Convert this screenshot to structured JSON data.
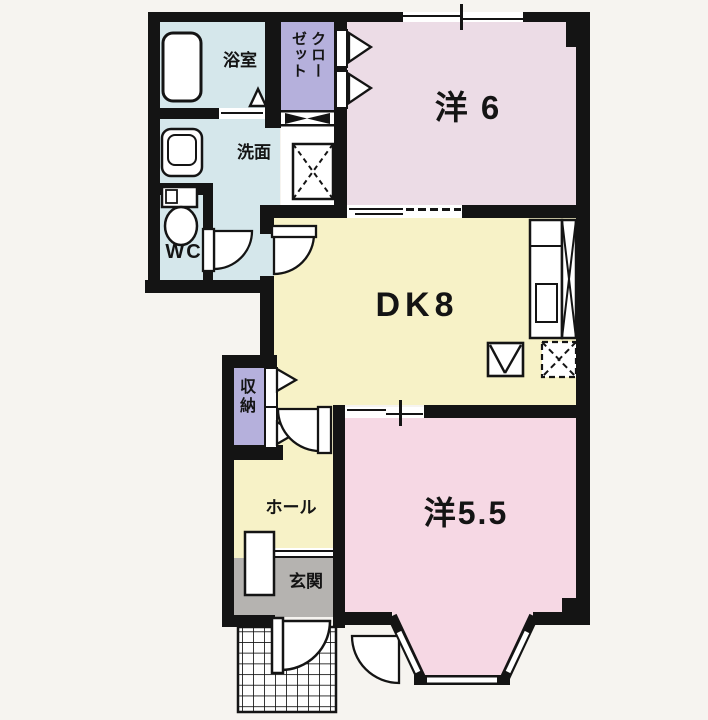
{
  "floorplan": {
    "rooms": {
      "bath": {
        "label": "浴室"
      },
      "closet": {
        "label": "クローゼット"
      },
      "western_6": {
        "label": "洋 6"
      },
      "washroom": {
        "label": "洗面"
      },
      "toilet": {
        "label": "WC"
      },
      "dining_kitchen": {
        "label": "DK8"
      },
      "storage": {
        "label": "収納"
      },
      "hall": {
        "label": "ホール"
      },
      "entrance": {
        "label": "玄関"
      },
      "western_5_5": {
        "label": "洋5.5"
      }
    },
    "colors": {
      "background": "#f6f4f0",
      "wall": "#141414",
      "wet_area_blue": "#d5e7eb",
      "closet_purple": "#b5b0dc",
      "bedroom6_pink": "#ecdce6",
      "bedroom55_pink": "#f6d8e4",
      "dk_yellow": "#f7f2c7",
      "entrance_gray": "#b5b3b0"
    },
    "icons": [
      "bathtub-icon",
      "washbasin-icon",
      "toilet-icon",
      "washing-machine-space-icon",
      "kitchen-counter-icon",
      "kitchen-sink-icon",
      "stove-space-icon",
      "refrigerator-space-icon",
      "shoe-cabinet-icon",
      "door-swing-icon",
      "folding-door-icon",
      "sliding-window-icon",
      "bay-window-icon",
      "entrance-porch-icon",
      "bath-door-icon",
      "closet-divider-icon"
    ]
  }
}
